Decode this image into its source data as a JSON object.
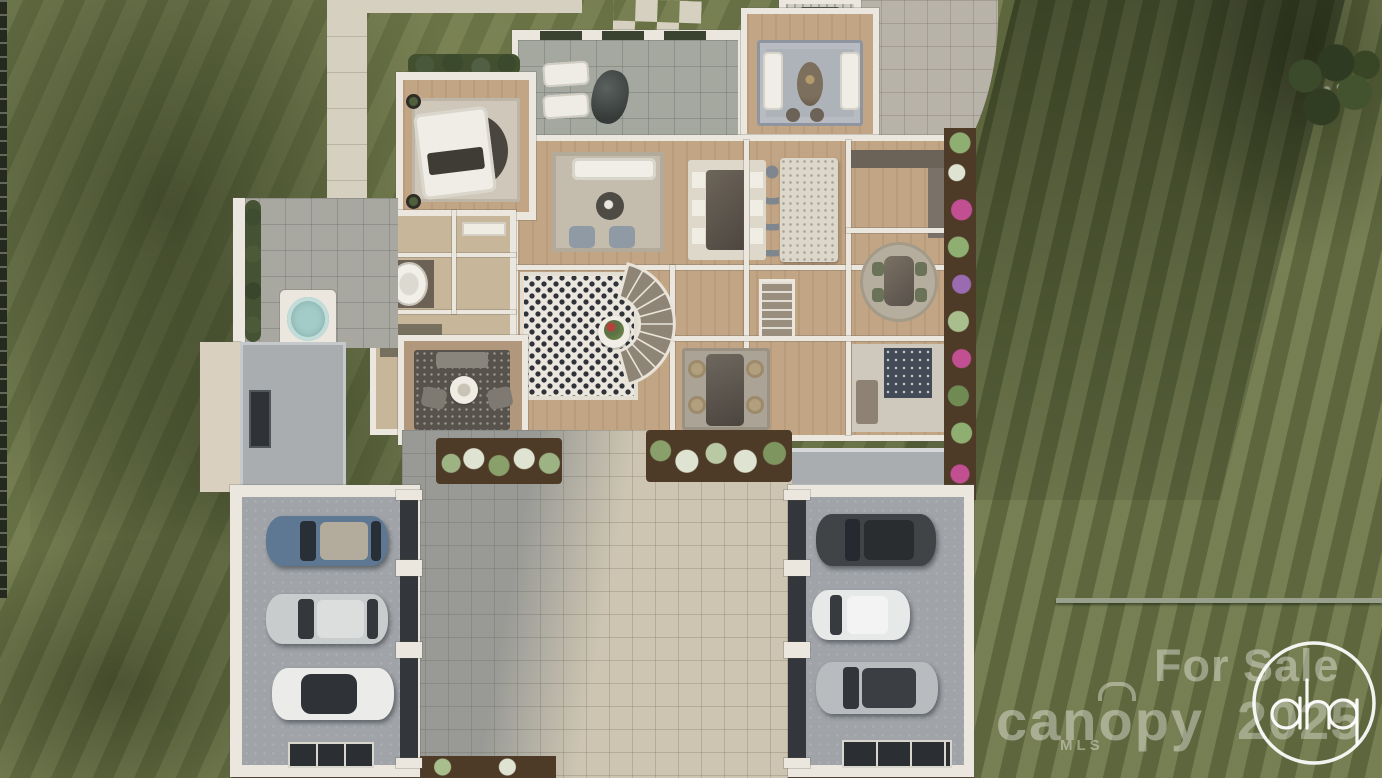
{
  "image": {
    "alt": "Aerial top-down 3D rendering of a luxury single-family home with roof removed showing furnished rooms, a black-and-white tiled foyer with curved staircase, twin three-car garages flanking a paver motor court, hot tub terrace, planting beds and striped manicured lawn"
  },
  "watermarks": {
    "for_sale": "For Sale",
    "brand": "canopy",
    "brand_sub": "MLS",
    "year": "2025",
    "logo": "ahp"
  },
  "palette": {
    "grass": "#6b7446",
    "grassdark": "#39442c",
    "concrete": "#d6d0c0",
    "pavers": "#cdc5b2",
    "paverscool": "#b7b3a9",
    "wall": "#ebe7df",
    "wood": "#c2a584",
    "terrace": "#a4a89f",
    "roof": "#a9adb0",
    "roofcream": "#d9d0bf",
    "garagefloor": "#a0a4a8",
    "doordark": "#33363a",
    "mulch": "#4e3b27",
    "hedge": "#3d4a2e",
    "checker": "#2f3338",
    "tubwater": "#a3cbc8",
    "watermark": "#ffffff"
  },
  "cars": {
    "left": [
      "#5e7893",
      "#c9cccd",
      "#ebebe9"
    ],
    "right": [
      "#404446",
      "#e7e9e8",
      "#b9bcbe"
    ]
  }
}
